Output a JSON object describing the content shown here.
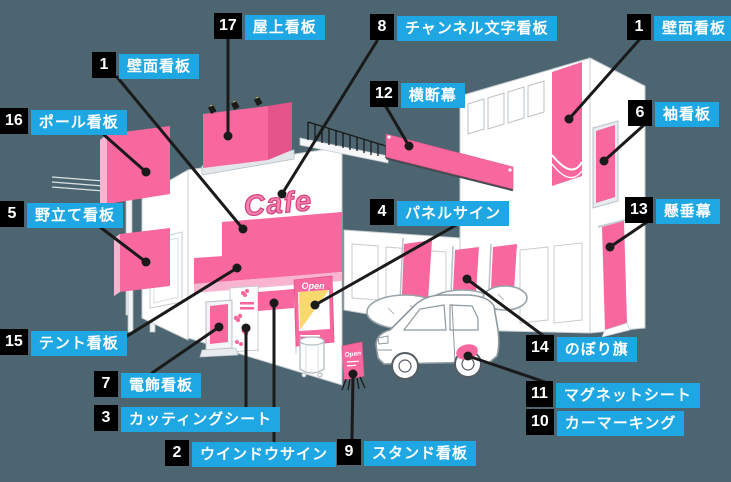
{
  "title": "店舗看板の種類 図解",
  "colors": {
    "background": "#4C6570",
    "label_blue": "#1EA7E2",
    "label_black": "#000000",
    "sign_pink": "#F8679E",
    "sign_pink_light": "#F9B5D0",
    "sign_pink_dark": "#E5538B",
    "accent_yellow": "#F9D96E",
    "leader_line": "#1A1A1A",
    "building_white": "#FFFFFF",
    "outline_gray": "#C6CCD1"
  },
  "scene": {
    "cafe_sign_text": "Cafe",
    "poster_text": "Open",
    "stand_sign_text": "Open"
  },
  "labels": {
    "l1a": {
      "number": "1",
      "text": "壁面看板"
    },
    "l1b": {
      "number": "1",
      "text": "壁面看板"
    },
    "l2": {
      "number": "2",
      "text": "ウインドウサイン"
    },
    "l3": {
      "number": "3",
      "text": "カッティングシート"
    },
    "l4": {
      "number": "4",
      "text": "パネルサイン"
    },
    "l5": {
      "number": "5",
      "text": "野立て看板"
    },
    "l6": {
      "number": "6",
      "text": "袖看板"
    },
    "l7": {
      "number": "7",
      "text": "電飾看板"
    },
    "l8": {
      "number": "8",
      "text": "チャンネル文字看板"
    },
    "l9": {
      "number": "9",
      "text": "スタンド看板"
    },
    "l10": {
      "number": "10",
      "text": "カーマーキング"
    },
    "l11": {
      "number": "11",
      "text": "マグネットシート"
    },
    "l12": {
      "number": "12",
      "text": "横断幕"
    },
    "l13": {
      "number": "13",
      "text": "懸垂幕"
    },
    "l14": {
      "number": "14",
      "text": "のぼり旗"
    },
    "l15": {
      "number": "15",
      "text": "テント看板"
    },
    "l16": {
      "number": "16",
      "text": "ポール看板"
    },
    "l17": {
      "number": "17",
      "text": "屋上看板"
    }
  }
}
